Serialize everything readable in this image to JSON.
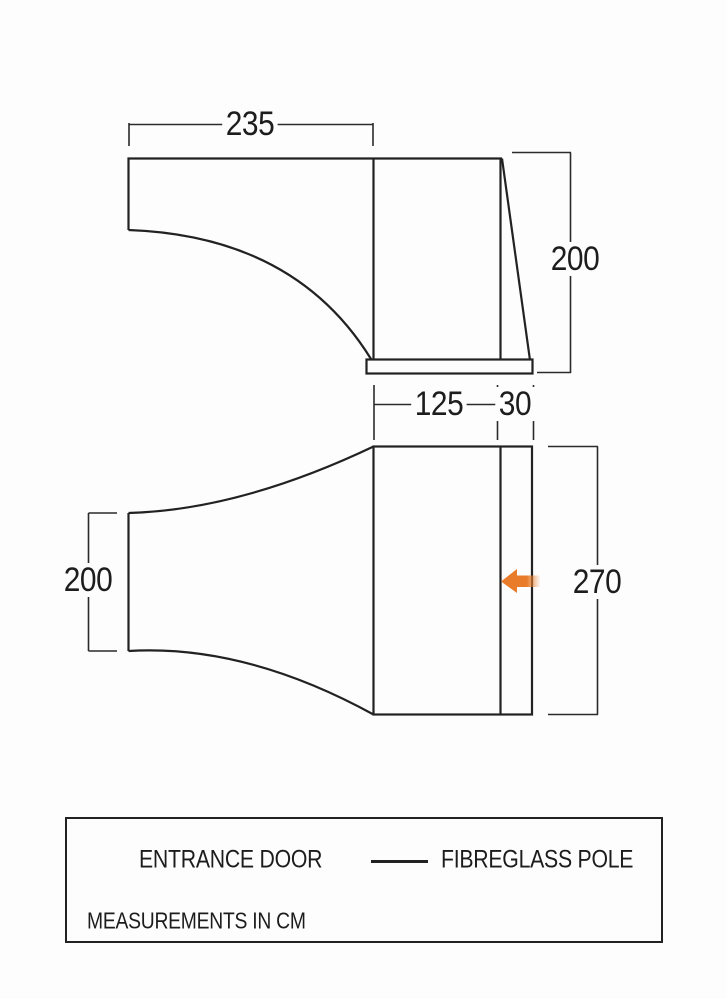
{
  "dimensions": {
    "side_view_width": "235",
    "side_view_height": "200",
    "plan_inner_width": "125",
    "plan_door_panel": "30",
    "plan_rear_width": "200",
    "plan_depth": "270"
  },
  "legend": {
    "entrance_door_label": "ENTRANCE DOOR",
    "fibreglass_pole_label": "FIBREGLASS POLE",
    "note": "MEASUREMENTS IN CM"
  },
  "icons": {
    "entrance_door": "orange-arrow-icon",
    "fibreglass_pole": "line-sample"
  },
  "colors": {
    "accent_orange": "#E87C2A",
    "line_black": "#222222",
    "background": "#fdfdfd"
  }
}
